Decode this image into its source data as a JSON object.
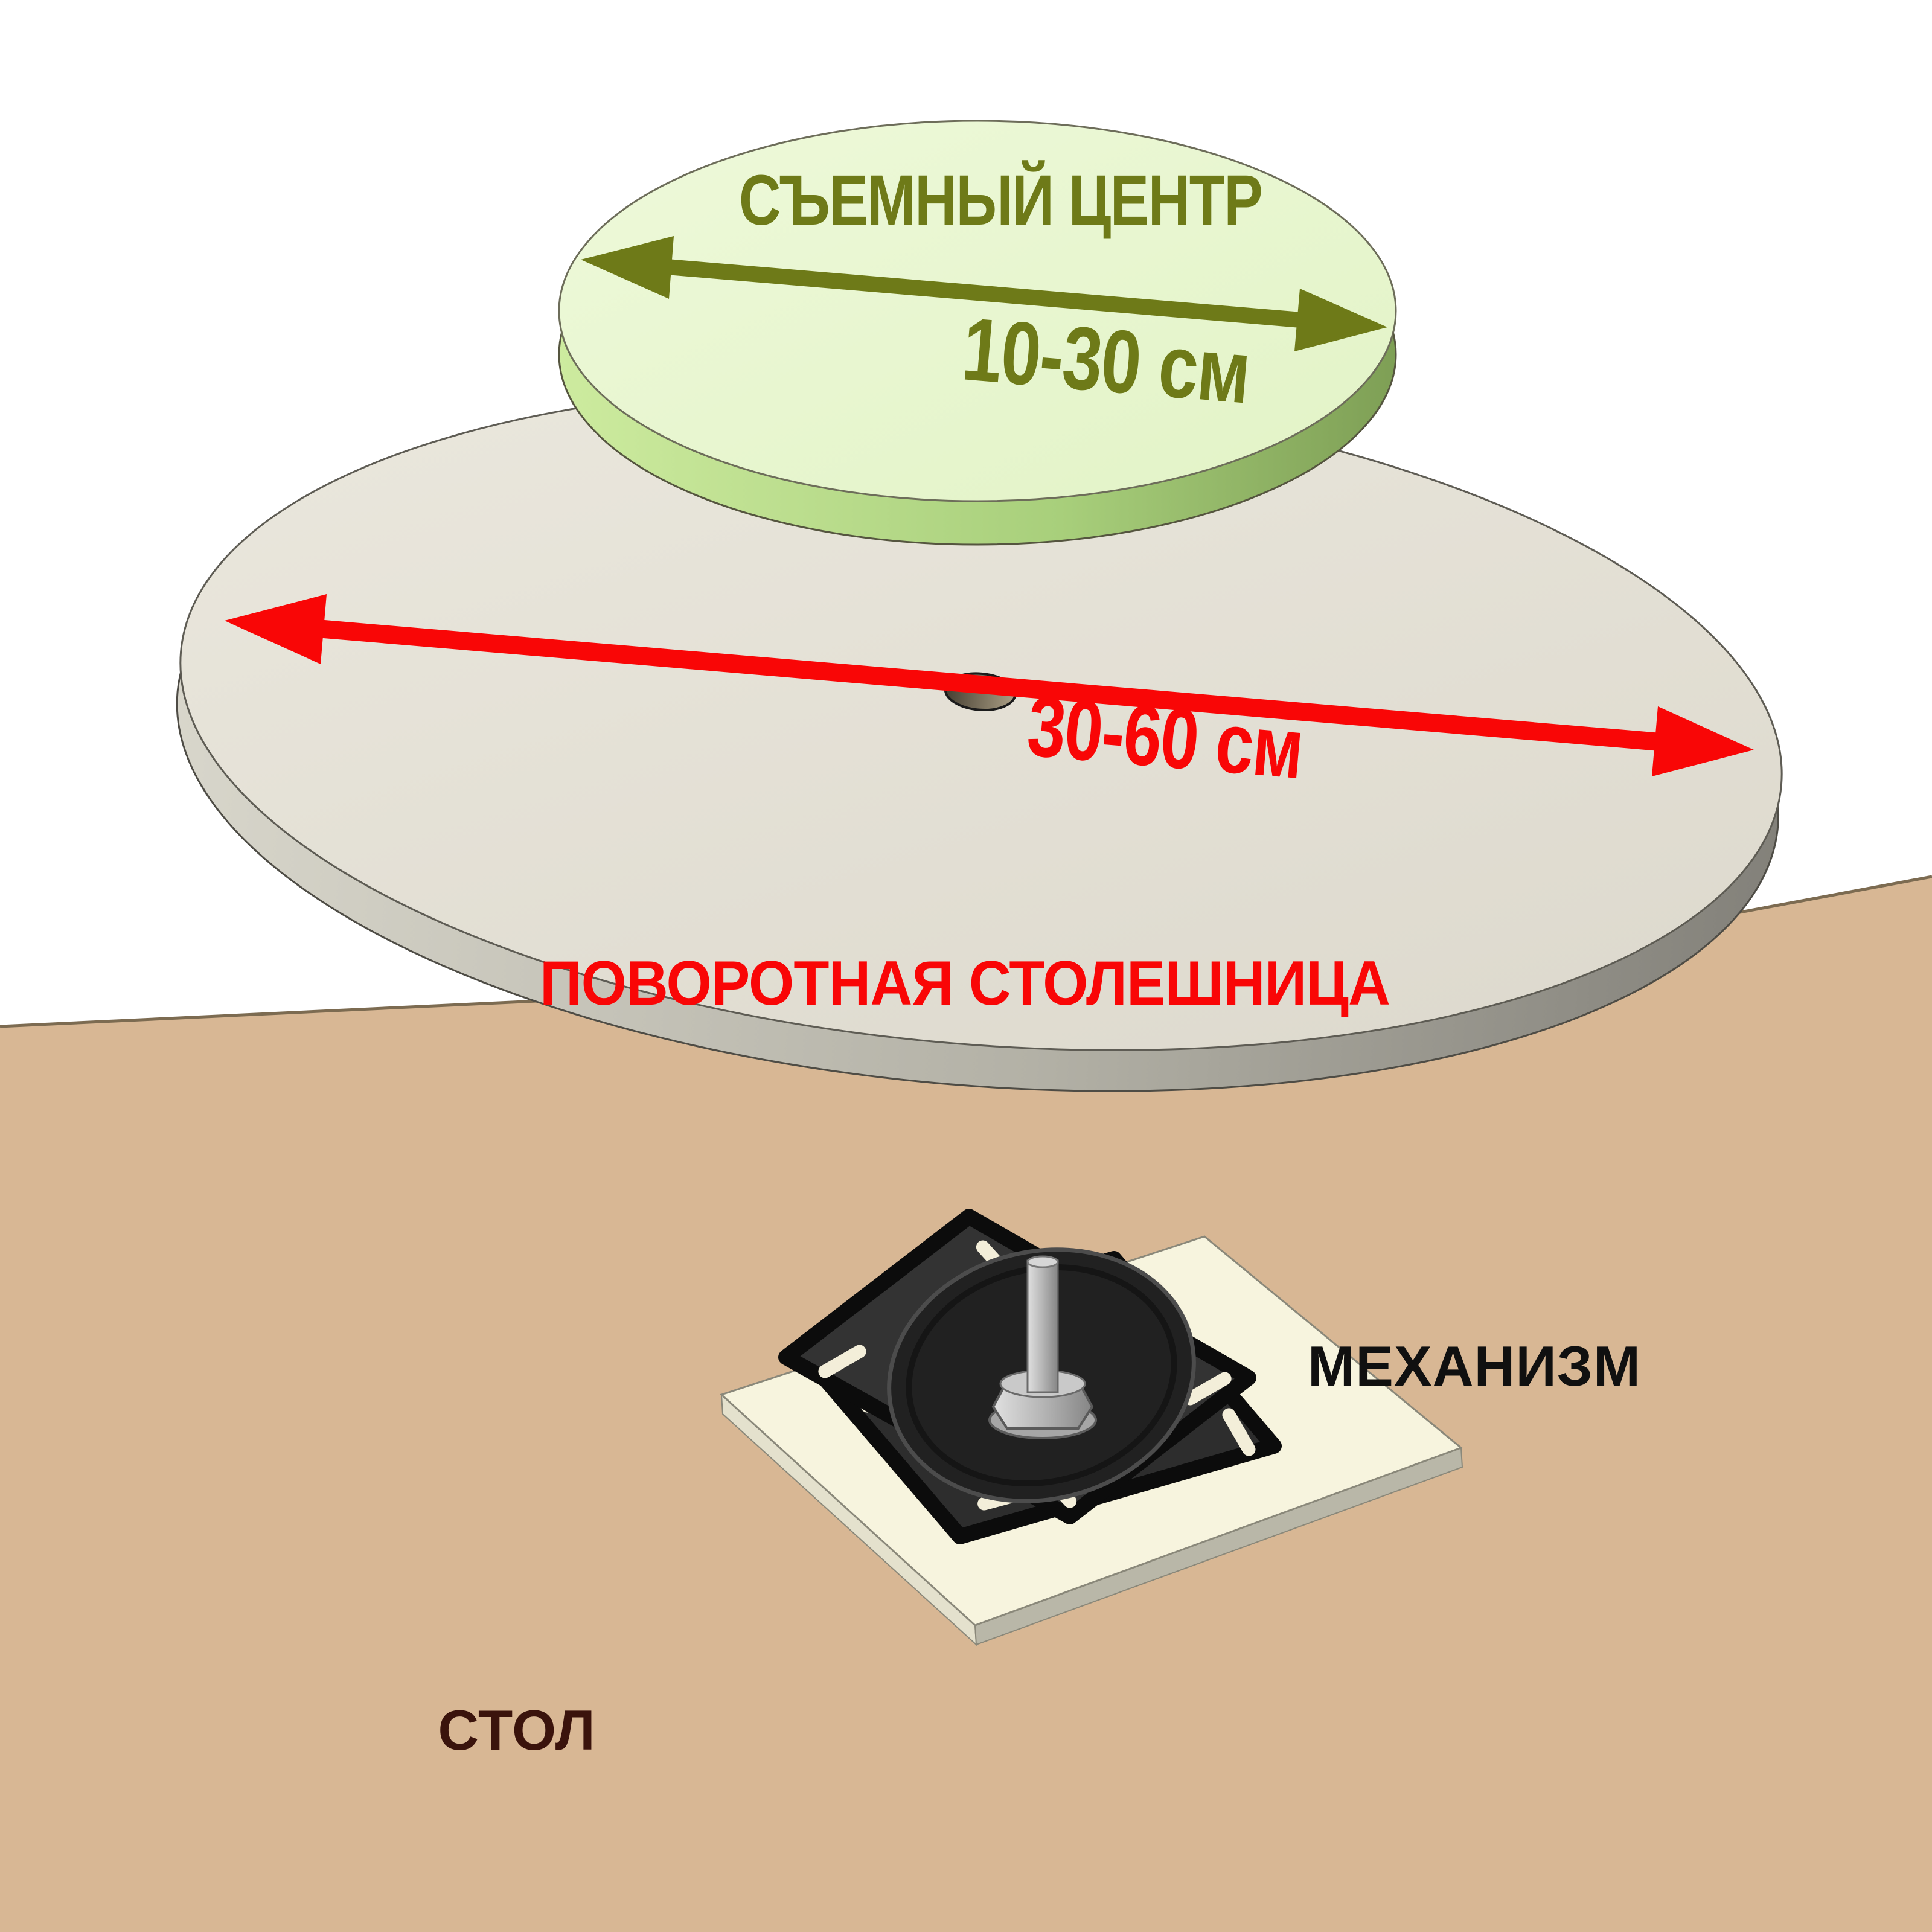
{
  "diagram": {
    "labels": {
      "removable_center": "СЪЕМНЫЙ ЦЕНТР",
      "removable_center_diameter": "10-30 см",
      "turntable": "ПОВОРОТНАЯ СТОЛЕШНИЦА",
      "turntable_diameter": "30-60 см",
      "mechanism": "МЕХАНИЗМ",
      "table": "СТОЛ"
    },
    "colors": {
      "olive": "#6e7a18",
      "red": "#f90606",
      "label-black": "#101010",
      "maroon": "#3a130c",
      "tan": "#d8b794",
      "gray-face": "#e6e2d7",
      "green-face": "#e9f7d1",
      "cream-plate": "#f7f4de",
      "plate-black": "#2d2d2d"
    }
  }
}
